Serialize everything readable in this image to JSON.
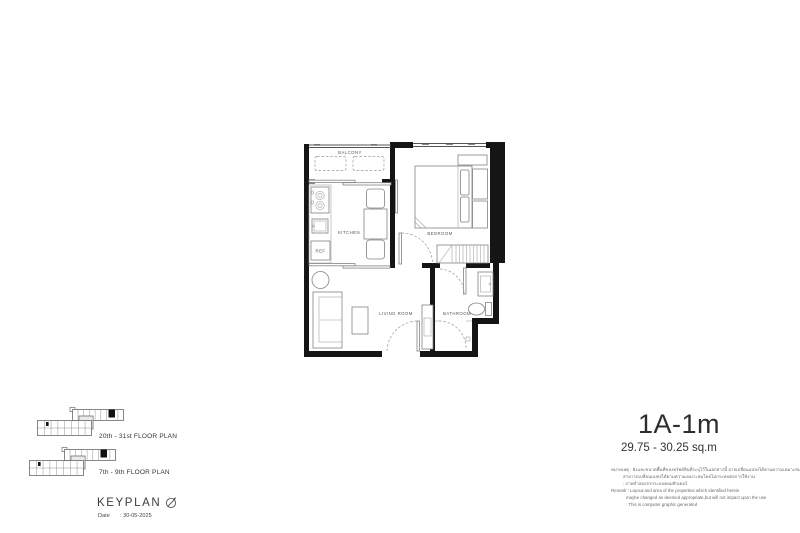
{
  "unit": {
    "name": "1A-1m",
    "area": "29.75 - 30.25 sq.m"
  },
  "plan_labels": {
    "balcony": "BALCONY",
    "kitchen": "KITCHEN",
    "bedroom": "BEDROOM",
    "living_room": "LIVING ROOM",
    "bathroom": "BATHROOM",
    "ref": "REF"
  },
  "keyplan": {
    "heading": "KEYPLAN",
    "date_label": "Date",
    "date_value": ": 30-05-2025",
    "floor_plans": [
      {
        "label": "20th - 31st FLOOR PLAN"
      },
      {
        "label": "7th - 9th FLOOR PLAN"
      }
    ]
  },
  "remarks": {
    "th_line1": "หมายเหตุ : ผังและขนาดพื้นที่ของทรัพย์สินที่ระบุไว้ในเอกสารนี้ อาจเปลี่ยนแปลงได้ตามความเหมาะสม ซึ่งไม่มีผลกระทบต่อ",
    "th_line2": "สามารถเปลี่ยนแปลงได้ตามความเหมาะสมโดยไม่กระทบต่อการใช้งาน",
    "th_line3": ": ภาพจำลองจากระบบคอมพิวเตอร์",
    "en_line1": "Remark : Layout and area of the properties which identified herein",
    "en_line2": "maybe changed as deemed appropriate,but will not impact upon the use",
    "en_line3": ": This is computer graphic generated"
  },
  "colors": {
    "wall": "#151515",
    "furniture_line": "#838383",
    "label_text": "#555555",
    "background": "#ffffff"
  }
}
